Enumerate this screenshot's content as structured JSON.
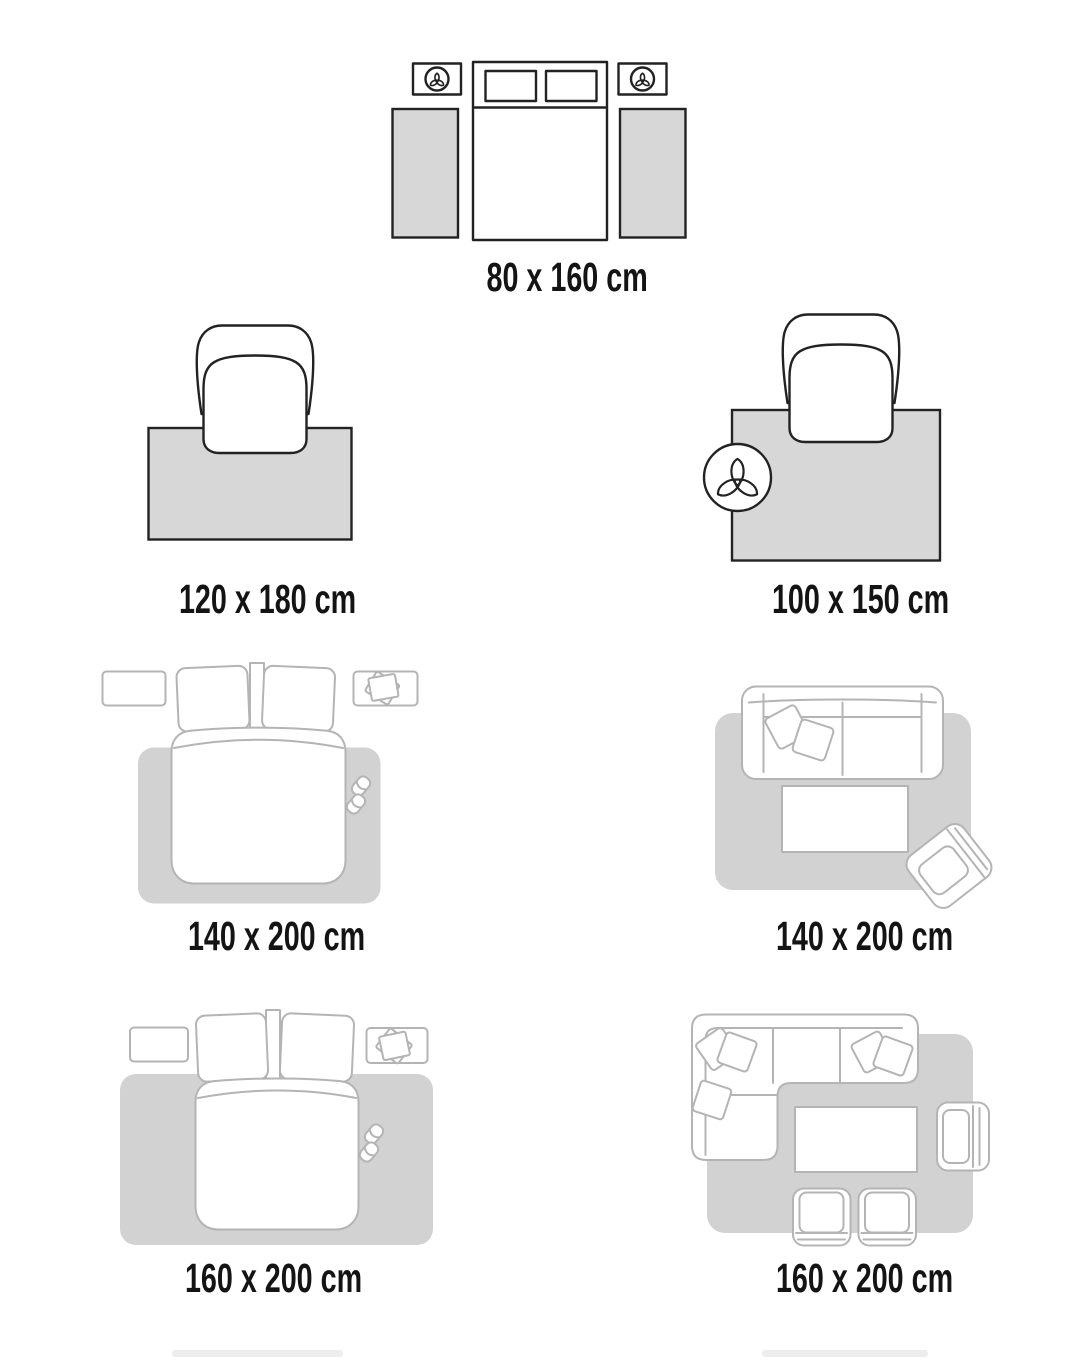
{
  "page": {
    "title": "Rug size guide",
    "background": "#ffffff"
  },
  "colors": {
    "ink_dark": "#222222",
    "ink_light": "#b4b4b4",
    "rug_fill": "#d7d7d7",
    "rug_soft": "#d2d2d2",
    "label_color": "#141414",
    "page_bg": "#ffffff"
  },
  "sections": [
    {
      "id": "bed-runners-80x160",
      "label": "80 x 160 cm",
      "scene": "double bed flanked by two nightstands with plants and two runner rugs"
    },
    {
      "id": "chair-rug-120x180",
      "label": "120 x 180 cm",
      "scene": "armchair standing on top edge of rug"
    },
    {
      "id": "chair-rug-100x150",
      "label": "100 x 150 cm",
      "scene": "armchair on rug with potted plant at left edge"
    },
    {
      "id": "bed-rug-140x200",
      "label": "140 x 200 cm",
      "scene": "double bed on rug with two nightstands and slippers"
    },
    {
      "id": "sofa-rug-140x200",
      "label": "140 x 200 cm",
      "scene": "two-seat sofa, coffee table and armchair on rug"
    },
    {
      "id": "bed-rug-160x200",
      "label": "160 x 200 cm",
      "scene": "double bed on wider rug with two nightstands and slippers"
    },
    {
      "id": "sofa-rug-160x200",
      "label": "160 x 200 cm",
      "scene": "corner sofa, coffee table, armchair and two chairs on rug"
    }
  ],
  "partial_bottom_row": {
    "visible": true,
    "description": "tops of two more size labels cut off at bottom edge"
  }
}
